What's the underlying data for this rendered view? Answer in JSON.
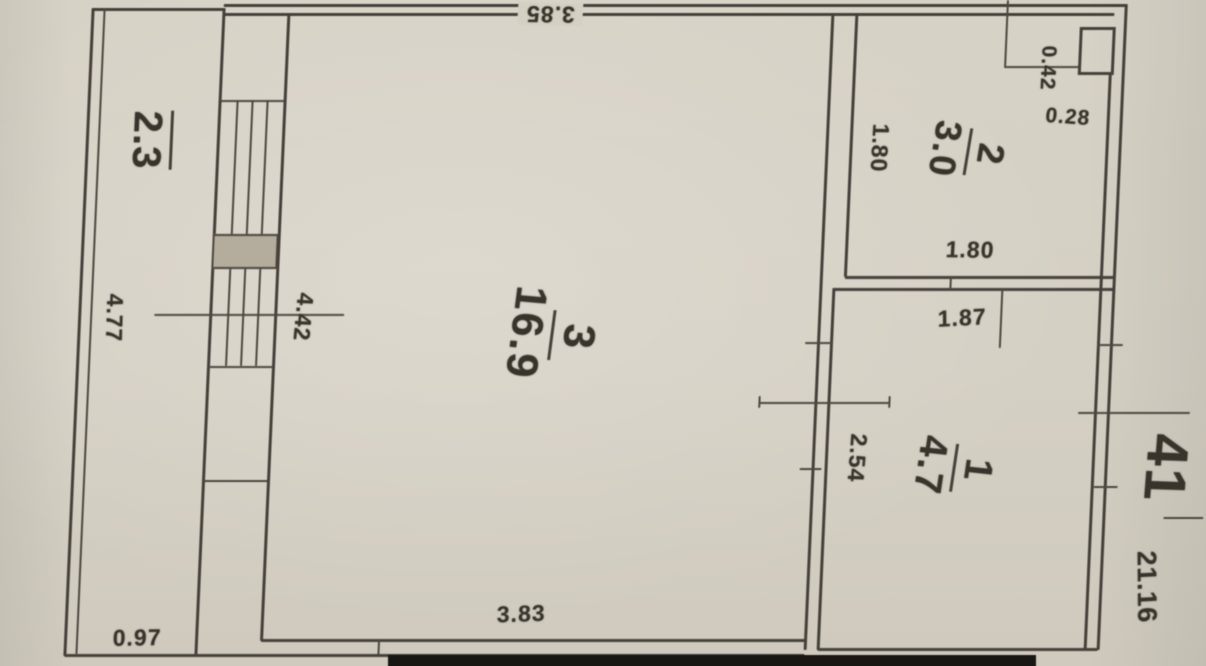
{
  "plan": {
    "apartment_number": "41",
    "total_area": "21.16",
    "rooms": {
      "balcony": {
        "area": "2.3"
      },
      "room3": {
        "number": "3",
        "area": "16.9"
      },
      "room2": {
        "number": "2",
        "area": "3.0"
      },
      "room1": {
        "number": "1",
        "area": "4.7"
      }
    },
    "dimensions": {
      "room3_width_top": "3.85",
      "room3_width_bottom": "3.83",
      "room3_depth": "4.42",
      "balcony_length": "4.77",
      "balcony_width": "0.97",
      "room2_depth_left": "1.80",
      "room2_width_bottom": "1.80",
      "room1_width_top": "1.87",
      "room1_depth": "2.54",
      "shaft_depth": "0.42",
      "shaft_width": "0.28"
    },
    "colors": {
      "paper": "#d5d0c4",
      "ink": "#45403a"
    }
  }
}
